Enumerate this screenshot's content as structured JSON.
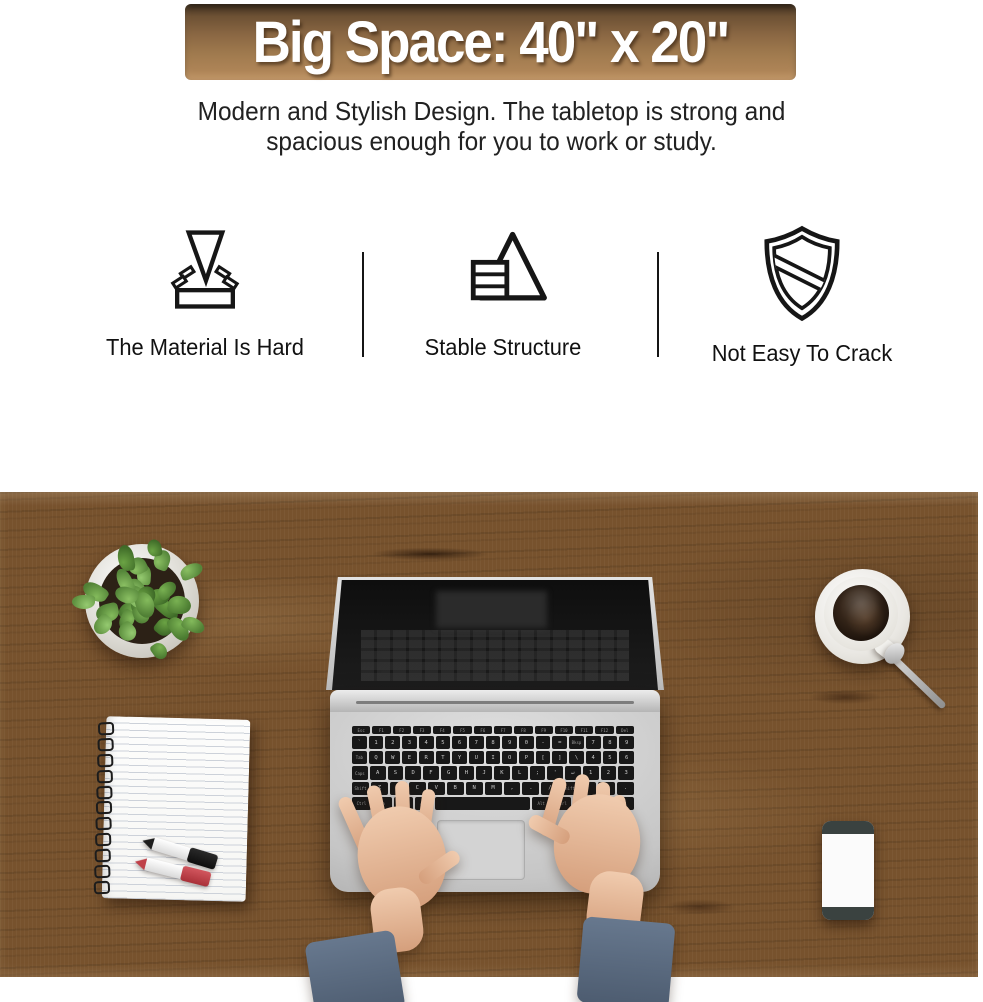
{
  "banner": {
    "text": "Big Space: 40\" x 20\""
  },
  "subtitle": {
    "line1": "Modern and Stylish Design. The tabletop is strong and",
    "line2": "spacious enough for you to work or study."
  },
  "features": [
    {
      "icon": "impact-hardness-icon",
      "label": "The Material Is Hard"
    },
    {
      "icon": "pyramid-stability-icon",
      "label": "Stable Structure"
    },
    {
      "icon": "shield-icon",
      "label": "Not Easy To Crack"
    }
  ],
  "colors": {
    "banner_top": "#3f2f1f",
    "banner_bottom": "#b68a5c",
    "wood": "#77522d",
    "sleeve": "#5c6c81",
    "marker_red": "#c9454d"
  },
  "photo": {
    "objects": [
      "potted-plant",
      "coffee-cup",
      "spoon",
      "laptop",
      "hands-typing",
      "spiral-notebook",
      "marker-black",
      "marker-red",
      "smartphone"
    ],
    "notebook": {
      "rings": 11
    },
    "laptop": {
      "keyboard": {
        "rows": [
          [
            "Esc",
            "F1",
            "F2",
            "F3",
            "F4",
            "F5",
            "F6",
            "F7",
            "F8",
            "F9",
            "F10",
            "F11",
            "F12",
            "Del"
          ],
          [
            "`",
            "1",
            "2",
            "3",
            "4",
            "5",
            "6",
            "7",
            "8",
            "9",
            "0",
            "-",
            "=",
            "Bksp",
            "7",
            "8",
            "9"
          ],
          [
            "Tab",
            "Q",
            "W",
            "E",
            "R",
            "T",
            "Y",
            "U",
            "I",
            "O",
            "P",
            "[",
            "]",
            "\\",
            "4",
            "5",
            "6"
          ],
          [
            "Caps",
            "A",
            "S",
            "D",
            "F",
            "G",
            "H",
            "J",
            "K",
            "L",
            ";",
            "'",
            "↵",
            "1",
            "2",
            "3"
          ],
          [
            "Shift",
            "Z",
            "X",
            "C",
            "V",
            "B",
            "N",
            "M",
            ",",
            ".",
            "/",
            "Shift",
            "↑",
            "0",
            "."
          ],
          [
            "Ctrl",
            "Fn",
            "Win",
            "Alt",
            "Space",
            "Alt",
            "Ctrl",
            "←",
            "↓",
            "→"
          ]
        ]
      }
    }
  }
}
